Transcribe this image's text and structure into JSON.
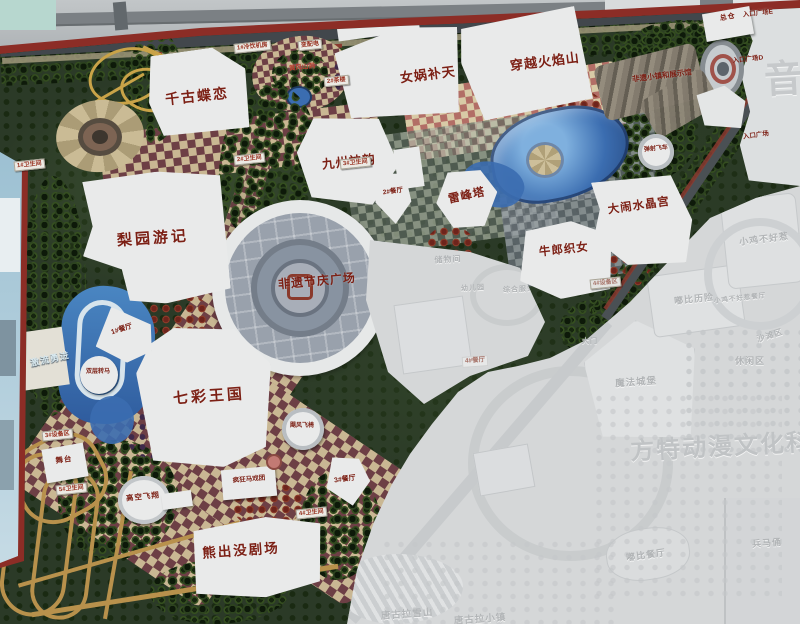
{
  "labels": {
    "qiangu_dielian": "千古蝶恋",
    "nvwa_butian": "女娲补天",
    "chuanyue_huoyanshan": "穿越火焰山",
    "zongcang": "总仓",
    "jiuzhou_shenyun": "九州神韵",
    "liyuan_youji": "梨园游记",
    "leifengta": "雷峰塔",
    "niulang_zhinv": "牛郎织女",
    "danao_shuijinggong": "大闹水晶宫",
    "qicai_wangguo": "七彩王国",
    "xiongchumo_juchang": "熊出没剧场",
    "feiyi_jieqing_guangchang": "非遗节庆广场",
    "jiliu_yongjin": "激流勇进",
    "gaokong_feixiang": "高空飞翔",
    "shuangceng_zhuanma": "双层转马",
    "jufeng_feiyi": "飓风飞椅",
    "fengkuang_maxituan": "疯狂马戏团",
    "tanshe_feiche": "弹射飞车",
    "huangfeng_shandong": "黄风山洞",
    "wutai": "舞台",
    "canting_1": "1#餐厅",
    "canting_2": "2#餐厅",
    "canting_3": "3#餐厅",
    "lengyin_jifang": "1#冷饮机房",
    "bianpeidian": "变配电",
    "chalou": "2#茶楼",
    "wc_1": "1#卫生间",
    "wc_2": "2#卫生间",
    "wc_3": "3#卫生间",
    "wc_4": "4#卫生间",
    "wc_5": "5#卫生间",
    "shebeiqu_3": "3#设备区",
    "shebeiqu_4": "4#设备区",
    "rukou_e": "入口广场E",
    "rukou_d": "入口广场D",
    "rukou_c": "入口广场",
    "feiyi_xiaozhen": "非遗小镇和展示馆"
  },
  "faded_labels": {
    "chuwujian": "储物间",
    "youeryuan": "幼儿园",
    "zonghe_fuwulou": "综合服务楼",
    "canting_4": "4#餐厅",
    "damen": "大门",
    "dubi_lixian": "嘟比历险",
    "xiaoji_buhaore": "小鸡不好惹",
    "xiaoji_canting": "小鸡不好惹餐厅",
    "xiuxianqu": "休闲区",
    "shatanqu": "沙滩区",
    "mofa_chengbao": "魔法城堡",
    "dubi_canting": "嘟比餐厅",
    "tanggula_xueshan": "唐古拉雪山",
    "tanggula_xiaozhen": "唐古拉小镇",
    "bingmayong": "兵马俑"
  },
  "watermarks": {
    "park_title": "方特动漫文化科技",
    "edge_char": "音"
  },
  "colors": {
    "label_red": "#7c2015",
    "board_trim_red": "#8c2d26",
    "water_blue": "#3b6db0",
    "checker_maroon": "#6d3f45",
    "checker_tan": "#c9b793",
    "faded_text": "#b1b4b6",
    "sky_blue": "#9cc0d2"
  }
}
